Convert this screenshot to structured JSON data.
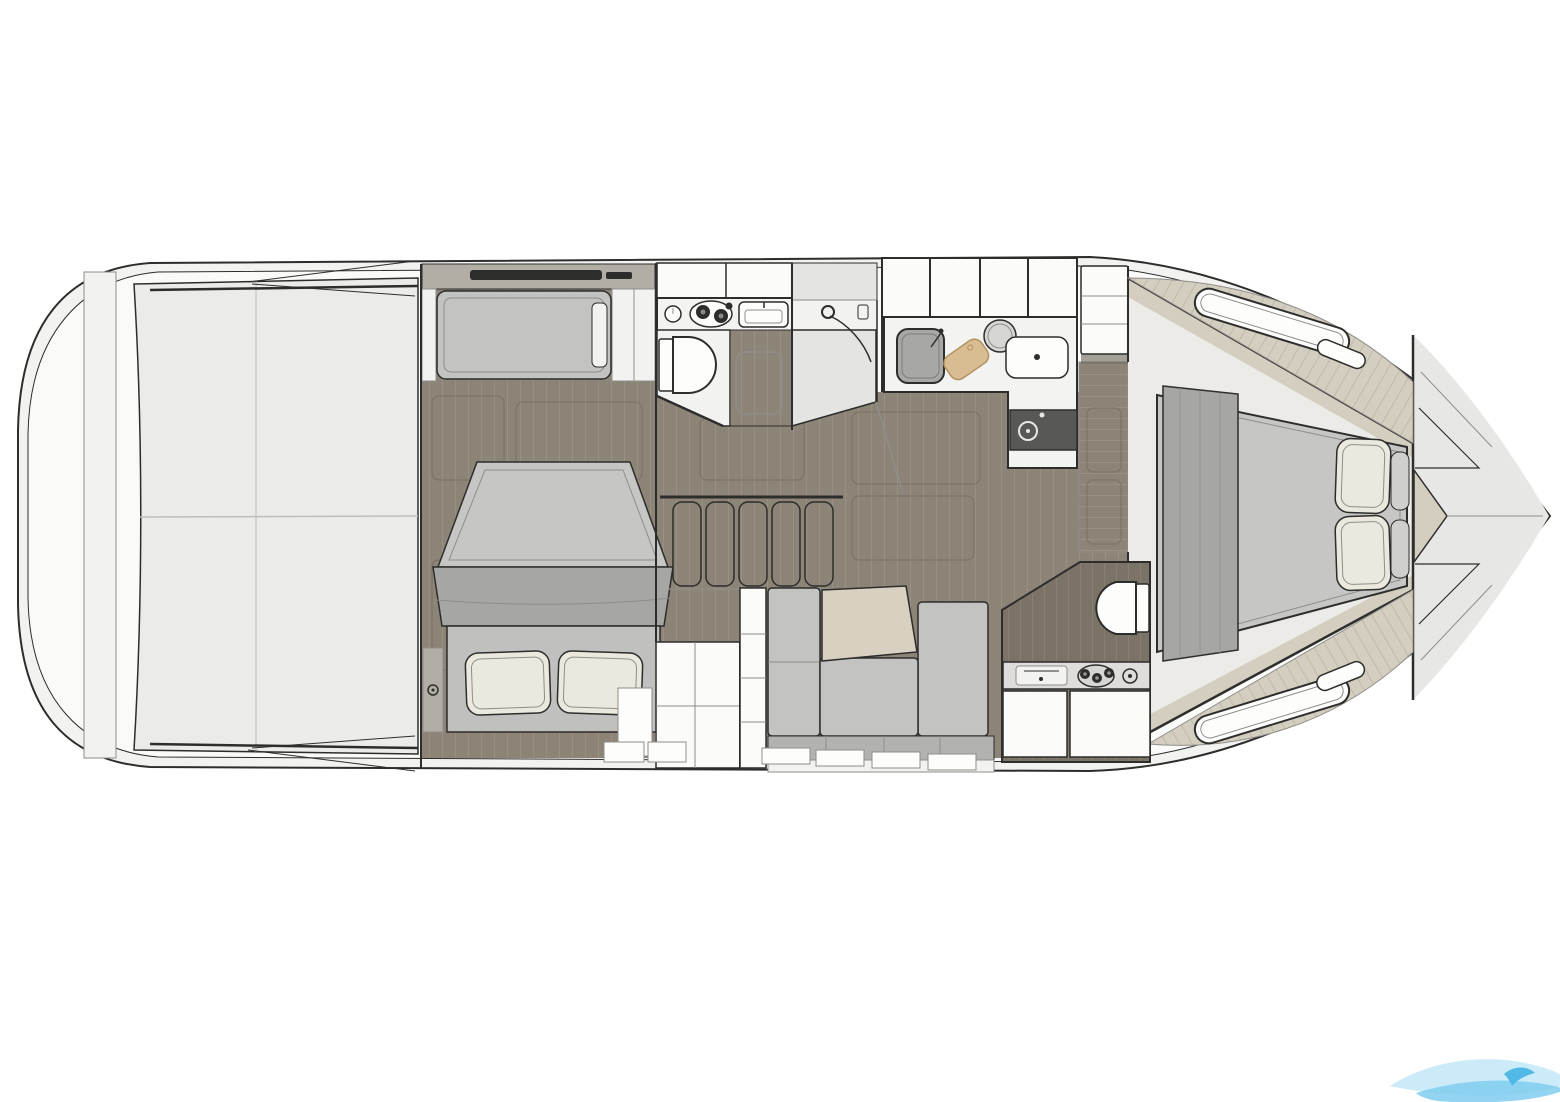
{
  "page": {
    "title": "Motor yacht interior deck plan",
    "description": "Top-down interior floor plan of a motor yacht hull, bow pointing right, showing aft cabin, galley, two heads, dinette and forward owner cabin"
  },
  "colors": {
    "paper": "#ffffff",
    "line": "#2d2d2b",
    "lineSoft": "#8f8d89",
    "hullFill": "#f2f2f1",
    "deckFill": "#fafaf9",
    "bowFill": "#e7e7e6",
    "panel": "#ebebea",
    "panelSeam": "#bdbdbb",
    "wood": "#8d8478",
    "woodLine": "#998f83",
    "woodSeam": "#6e6557",
    "woodDark": "#7b7367",
    "woodDarkLine": "#878072",
    "deckWood": "#d4cec1",
    "deckWoodLine": "#c0b9a9",
    "mattress": "#c6c6c4",
    "blanket": "#a6a6a4",
    "bedBase": "#c0c0be",
    "pillow": "#ebe8dd",
    "pillowGray": "#cfcfcd",
    "cushion": "#c3c3c1",
    "cushionDark": "#b2b2b0",
    "backrest": "#f2f2f0",
    "counter": "#f3f3f2",
    "cabinet": "#fbfbfa",
    "white": "#fdfdfc",
    "sinkGray": "#a7a7a5",
    "bowlGray": "#d6d6d4",
    "board": "#d9bd92",
    "boardEdge": "#b3925f",
    "cooktop": "#585856",
    "tableTan": "#d8d0c0",
    "shelfStrip": "#b2aea5",
    "vanity": "#dedddb",
    "grayPanel": "#e4e4e3",
    "waveLight": "#c7e9f8",
    "waveMid": "#7fcdef",
    "waveDark": "#45b3e3"
  },
  "vessel": {
    "type": "motor-yacht-deck-plan",
    "orientation": "bow-right",
    "zones": [
      {
        "id": "swim-platform",
        "name": "stern swim platform"
      },
      {
        "id": "cockpit",
        "name": "aft cockpit sun area"
      },
      {
        "id": "aft-cabin",
        "name": "aft cabin with double bed, side berth and wardrobe"
      },
      {
        "id": "galley-aft",
        "name": "galley with two-burner stove and sink"
      },
      {
        "id": "head-aft",
        "name": "aft head with toilet and separate shower"
      },
      {
        "id": "companionway",
        "name": "companionway stairs"
      },
      {
        "id": "galley-forward",
        "name": "forward galley counter with sinks, cutting board and cooktop"
      },
      {
        "id": "salon-dinette",
        "name": "salon dinette with U-shaped sofa and table"
      },
      {
        "id": "head-forward",
        "name": "forward head with toilet and vanity"
      },
      {
        "id": "forward-cabin",
        "name": "forward owner cabin with island berth"
      },
      {
        "id": "bow",
        "name": "bow foredeck with anchor locker"
      }
    ],
    "fixtures": [
      {
        "icon": "stove-burners-icon",
        "zone": "galley-aft"
      },
      {
        "icon": "galley-sink-icon",
        "zone": "galley-aft"
      },
      {
        "icon": "toilet-icon",
        "zone": "head-aft"
      },
      {
        "icon": "handheld-shower-icon",
        "zone": "head-aft"
      },
      {
        "icon": "square-sink-icon",
        "zone": "galley-forward"
      },
      {
        "icon": "cutting-board-icon",
        "zone": "galley-forward"
      },
      {
        "icon": "round-bowl-icon",
        "zone": "galley-forward"
      },
      {
        "icon": "basin-sink-icon",
        "zone": "galley-forward"
      },
      {
        "icon": "cooktop-icon",
        "zone": "galley-forward"
      },
      {
        "icon": "stairs-icon",
        "zone": "companionway"
      },
      {
        "icon": "dinette-table-icon",
        "zone": "salon-dinette"
      },
      {
        "icon": "toilet-icon",
        "zone": "head-forward"
      },
      {
        "icon": "vanity-sink-icon",
        "zone": "head-forward"
      },
      {
        "icon": "gauge-dial-icon",
        "zone": "head-forward"
      },
      {
        "icon": "double-bed-icon",
        "zone": "aft-cabin"
      },
      {
        "icon": "island-bed-icon",
        "zone": "forward-cabin"
      },
      {
        "icon": "hull-window-icon",
        "zone": "forward-cabin"
      }
    ]
  },
  "watermark": {
    "shape": "wave-swoosh"
  }
}
